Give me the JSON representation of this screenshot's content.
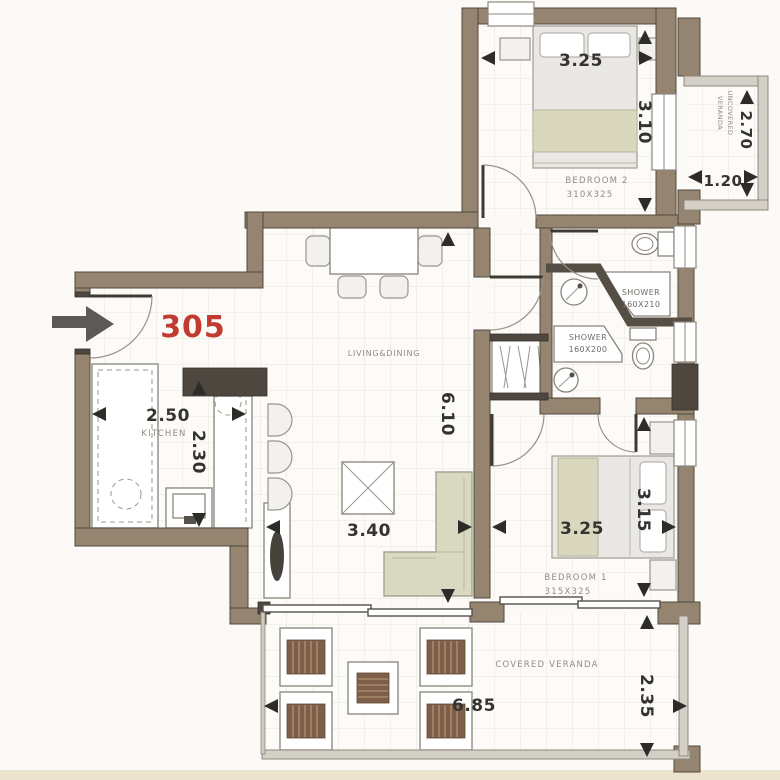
{
  "plan": {
    "unit_number": "305",
    "living": {
      "label": "LIVING&DINING",
      "width": "3.40",
      "height": "6.10"
    },
    "kitchen": {
      "label": "KITCHEN",
      "width": "2.50",
      "height": "2.30"
    },
    "bedroom2": {
      "label": "BEDROOM 2",
      "size": "310X325",
      "width": "3.25",
      "height": "3.10"
    },
    "bedroom1": {
      "label": "BEDROOM 1",
      "size": "315X325",
      "width": "3.25",
      "height": "3.15"
    },
    "shower_top": {
      "label": "SHOWER",
      "size": "160X210"
    },
    "shower_bottom": {
      "label": "SHOWER",
      "size": "160X200"
    },
    "covered_veranda": {
      "label": "COVERED VERANDA",
      "width": "6.85",
      "height": "2.35"
    },
    "uncovered_veranda": {
      "label_line1": "UNCOVERED",
      "label_line2": "VERANDA",
      "width": "1.20",
      "height": "2.70"
    }
  },
  "colors": {
    "wall": "#95846F",
    "dark_wall": "#4E473F",
    "unit_red": "#C23A30",
    "floor": "#FCFBF7",
    "grid": "#E6E4DC",
    "furniture_beige": "#D9D8C1",
    "blanket_beige": "#D9D7BD",
    "wood": "#7D5F49"
  }
}
